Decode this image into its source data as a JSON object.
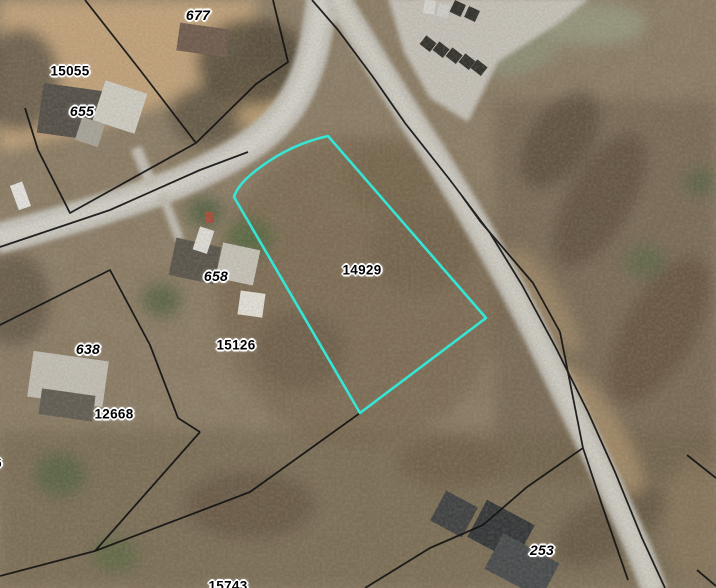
{
  "map": {
    "description": "Aerial parcel map with selected lot highlighted",
    "selected_parcel_id": "14929",
    "labels": {
      "a677": {
        "text": "677",
        "kind": "address"
      },
      "p15055": {
        "text": "15055",
        "kind": "parcel"
      },
      "a655": {
        "text": "655",
        "kind": "address"
      },
      "a658": {
        "text": "658",
        "kind": "address"
      },
      "p14929": {
        "text": "14929",
        "kind": "parcel"
      },
      "p15126": {
        "text": "15126",
        "kind": "parcel"
      },
      "a638": {
        "text": "638",
        "kind": "address"
      },
      "p12668": {
        "text": "12668",
        "kind": "parcel"
      },
      "p15743": {
        "text": "15743",
        "kind": "parcel"
      },
      "a253": {
        "text": "253",
        "kind": "address"
      },
      "partial6": {
        "text": "6",
        "kind": "parcel-partial"
      }
    },
    "palette": {
      "highlight_cyan": "#35e6d6",
      "parcel_line_black": "#141414",
      "label_text": "#000000",
      "label_halo": "#ffffff",
      "road_gray": "#cbc9c3"
    }
  }
}
